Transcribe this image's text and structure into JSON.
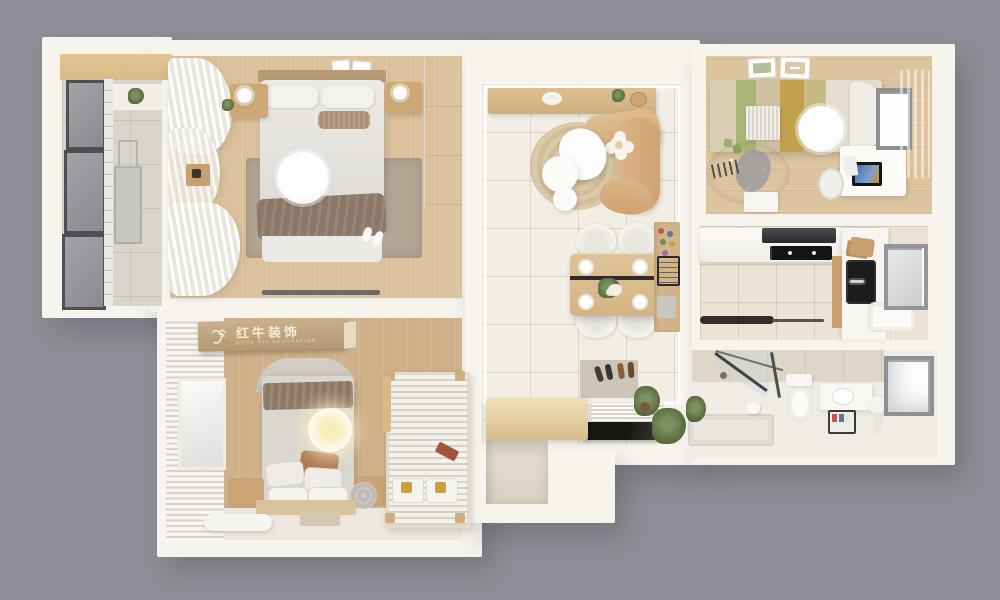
{
  "scene": {
    "type": "3D top-down apartment floor plan render",
    "background_color": "#8e8e96",
    "wall_color": "#f7f4ee"
  },
  "logo": {
    "text": "红牛装饰",
    "subtext": "HONG NIU DECORATION",
    "icon": "bull-icon",
    "panel_color": "#bda183",
    "text_color": "#f3ead6"
  },
  "palette": {
    "wood_floor": "#dcc29c",
    "living_tile": "#f2eee5",
    "balcony_tile": "#d8d5ce",
    "kitchen_tile": "#ebe4d6",
    "sofa_tan": "#d5ab7a",
    "rug_taupe": "#b5a694",
    "jute_rug": "#d9c6a6",
    "throw_brown": "#8d7867",
    "bedding_green": "#a9b574",
    "bedding_gold": "#c2a14e",
    "appliance_black": "#1b1b1b"
  },
  "rooms": [
    {
      "id": "balcony",
      "position": "top-left",
      "features": [
        "floor-to-ceiling-windows",
        "storage-cabinet",
        "drying-rack"
      ]
    },
    {
      "id": "master-bedroom",
      "position": "top-left-center",
      "features": [
        "double-bed",
        "ceiling-lamp",
        "nightstands",
        "wardrobe",
        "rug",
        "sheer-curtains",
        "slippers"
      ]
    },
    {
      "id": "living-dining-room",
      "position": "center",
      "features": [
        "curved-sofa",
        "flower-pouf",
        "coffee-tables",
        "round-jute-rug",
        "console",
        "dining-table",
        "four-chairs",
        "pegboard-cabinet"
      ]
    },
    {
      "id": "kids-bedroom",
      "position": "top-right",
      "features": [
        "bed",
        "scalloped-headboard",
        "ceiling-lamp",
        "play-rug",
        "desk",
        "monitor",
        "desk-chair",
        "window",
        "green-curtain"
      ]
    },
    {
      "id": "kitchen",
      "position": "right",
      "features": [
        "range-hood",
        "cooktop",
        "black-sink",
        "counters",
        "window"
      ]
    },
    {
      "id": "bathroom",
      "position": "bottom-right",
      "features": [
        "glass-shower",
        "shower-tray",
        "toilet",
        "vanity",
        "stool",
        "window"
      ]
    },
    {
      "id": "entry-hall",
      "position": "bottom-center",
      "features": [
        "shoe-mat",
        "slat-bench",
        "black-shoe-cabinet",
        "plants",
        "storage-niche",
        "wood-cabinet"
      ]
    },
    {
      "id": "second-bedroom",
      "position": "bottom-left",
      "features": [
        "bed-round-headboard",
        "glow-lamp",
        "pillow-pile",
        "nightstands",
        "slatted-daybed",
        "blinds-window",
        "brand-signboard"
      ]
    }
  ]
}
